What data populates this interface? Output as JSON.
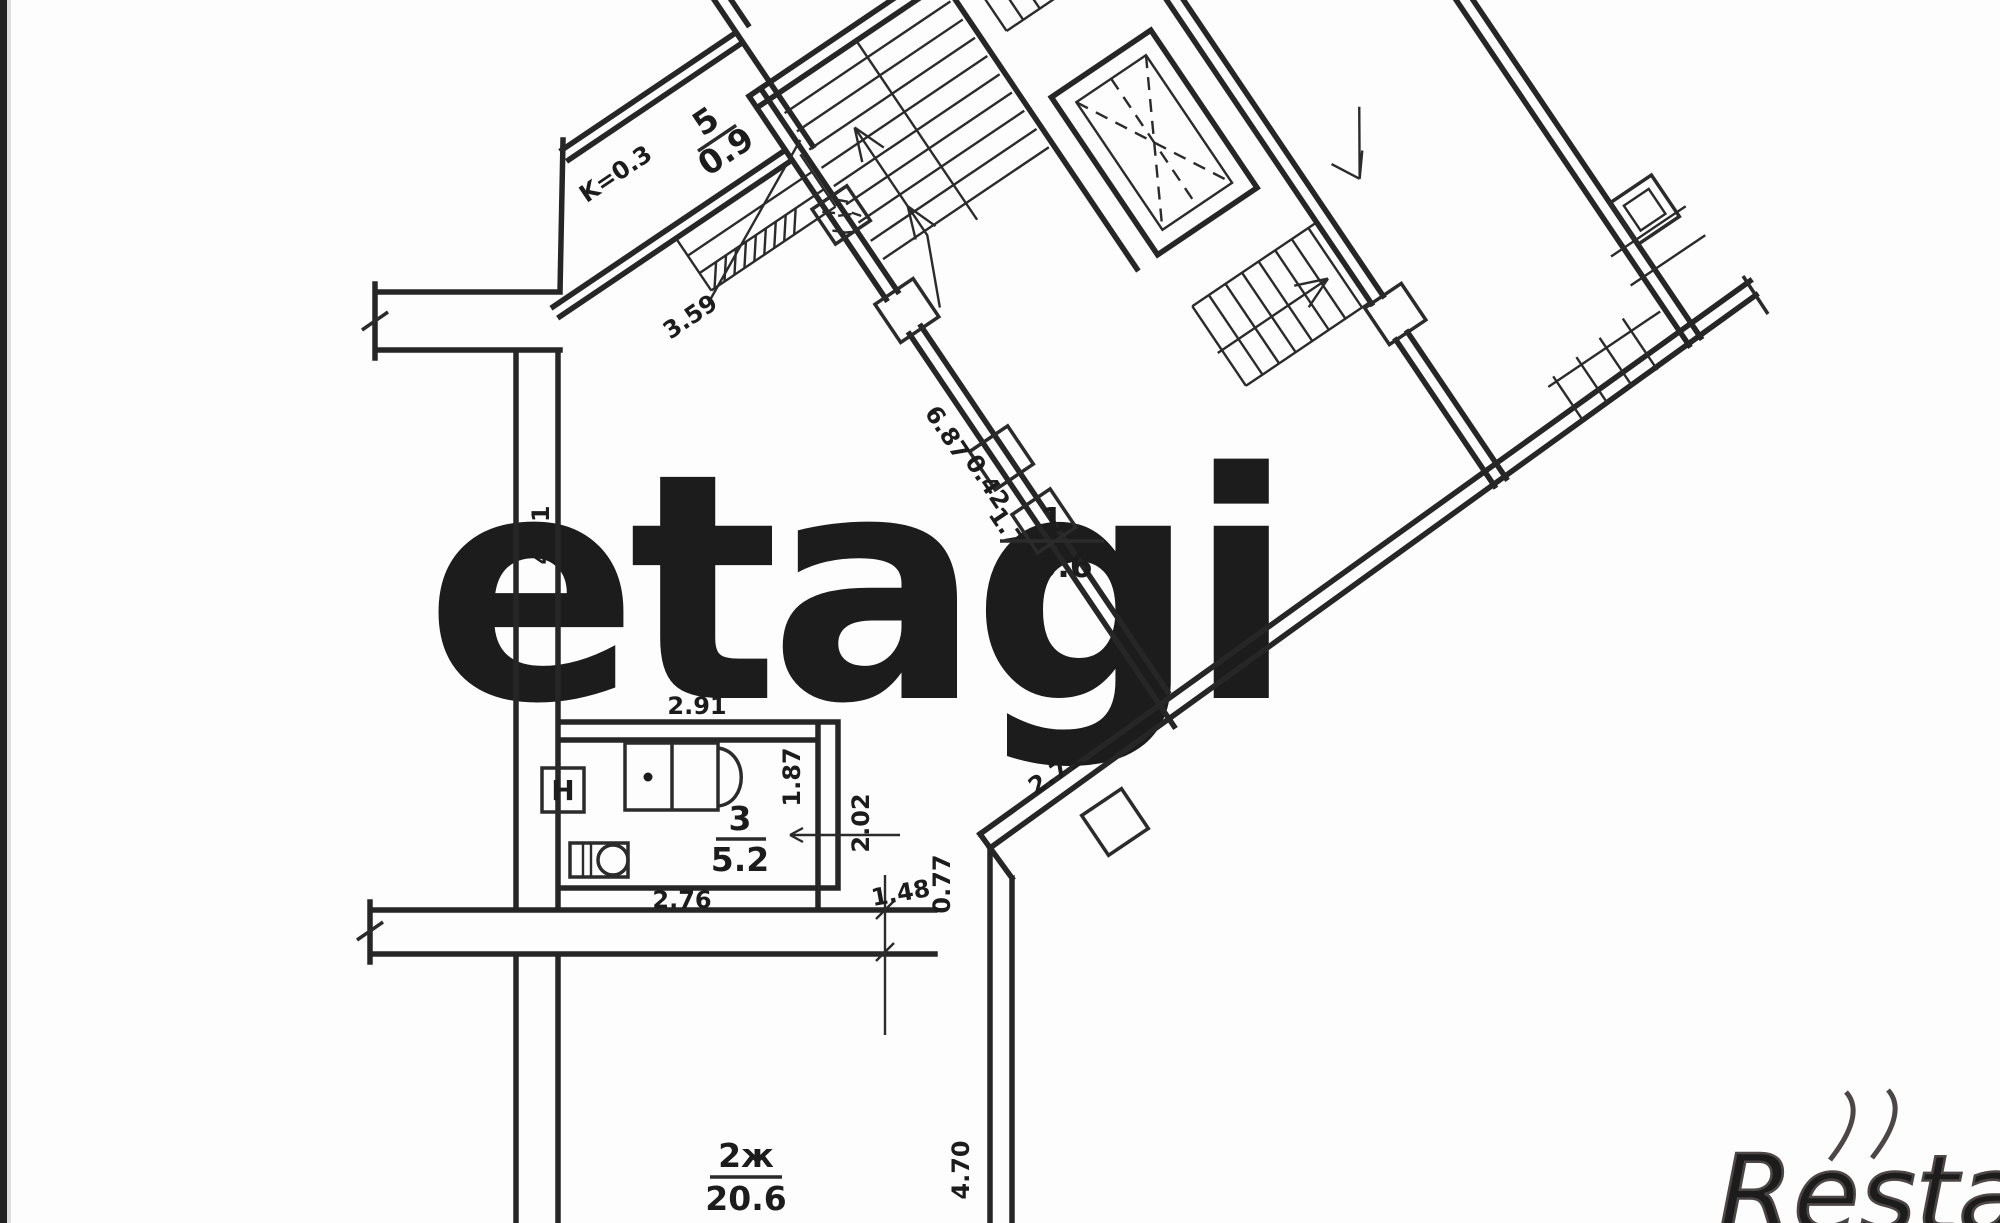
{
  "watermarks": {
    "center": "etagi",
    "corner": "Restate"
  },
  "coefficient": "K=0.3",
  "rooms": {
    "hall": {
      "number": "1",
      "area": "30.6"
    },
    "living": {
      "number": "2ж",
      "area": "20.6"
    },
    "bath": {
      "number": "3",
      "area": "5.2"
    },
    "balcony": {
      "number": "5",
      "area": "0.9"
    }
  },
  "fixtures": {
    "heater_label": "H"
  },
  "dims": {
    "balcony_steps": "3.59",
    "hall_left": "4.11",
    "bath_top": "2.91",
    "bath_bottom": "2.76",
    "bath_right": "1.87",
    "corridor_depth": "2.02",
    "corridor_width": "1.48",
    "opening": "0.77",
    "corridor_diag": "2.71",
    "stair_wall": "6.87",
    "window_small": "0.42",
    "window_gap": "1.70",
    "room2_right": "4.70"
  }
}
